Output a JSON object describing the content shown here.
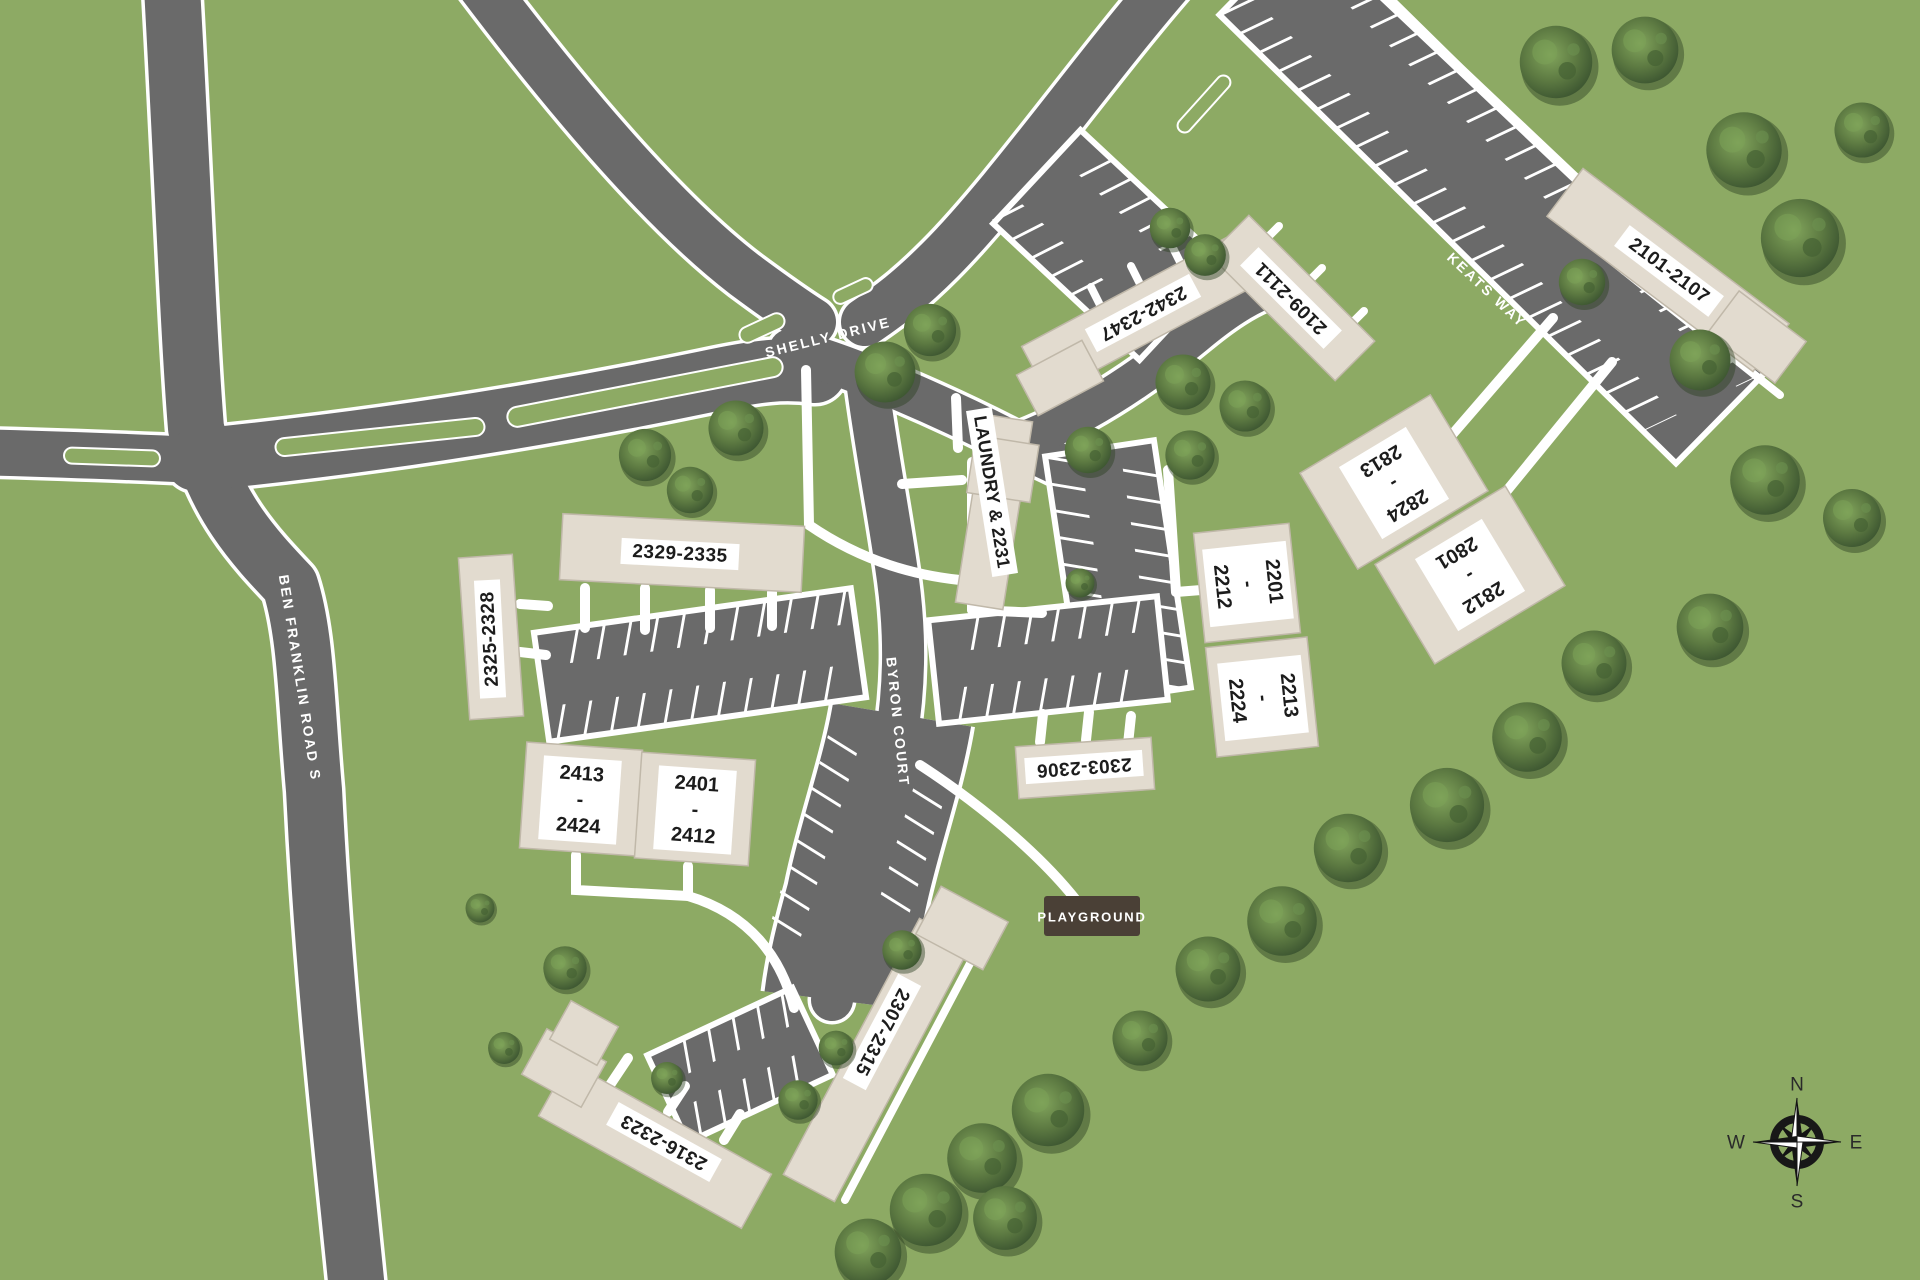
{
  "roads": {
    "shelly": "SHELLY DRIVE",
    "ben_franklin": "BEN FRANKLIN ROAD S",
    "byron": "BYRON COURT",
    "keats": "KEATS WAY"
  },
  "buildings": [
    {
      "id": "2329-2335",
      "label": "2329-2335"
    },
    {
      "id": "2325-2328",
      "label": "2325-2328"
    },
    {
      "id": "2413-2424",
      "lines": [
        "2413",
        "-",
        "2424"
      ]
    },
    {
      "id": "2401-2412",
      "lines": [
        "2401",
        "-",
        "2412"
      ]
    },
    {
      "id": "laundry-2231",
      "label": "LAUNDRY & 2231"
    },
    {
      "id": "2342-2347",
      "label": "2342-2347"
    },
    {
      "id": "2109-2111",
      "label": "2109-2111"
    },
    {
      "id": "2101-2107",
      "label": "2101-2107"
    },
    {
      "id": "2201-2212",
      "lines": [
        "2201",
        "-",
        "2212"
      ]
    },
    {
      "id": "2213-2224",
      "lines": [
        "2213",
        "-",
        "2224"
      ]
    },
    {
      "id": "2824-2813",
      "lines": [
        "2824",
        "-",
        "2813"
      ]
    },
    {
      "id": "2812-2801",
      "lines": [
        "2812",
        "-",
        "2801"
      ]
    },
    {
      "id": "2303-2306",
      "label": "2303-2306"
    },
    {
      "id": "2307-2315",
      "label": "2307-2315"
    },
    {
      "id": "2316-2323",
      "label": "2316-2323"
    }
  ],
  "poi": {
    "playground": "PLAYGROUND"
  },
  "compass": {
    "north": "N",
    "east": "E",
    "south": "S",
    "west": "W"
  },
  "colors": {
    "grass": "#8daa64",
    "road": "#6a6a6a",
    "building": "#e2dbcf",
    "building_edge": "#c0b8a9",
    "label_text": "#1c1c1c",
    "road_text": "#ffffff",
    "playground_bg": "#4a4036",
    "tree_dark": "#3b5430",
    "tree_light": "#7fa055"
  }
}
